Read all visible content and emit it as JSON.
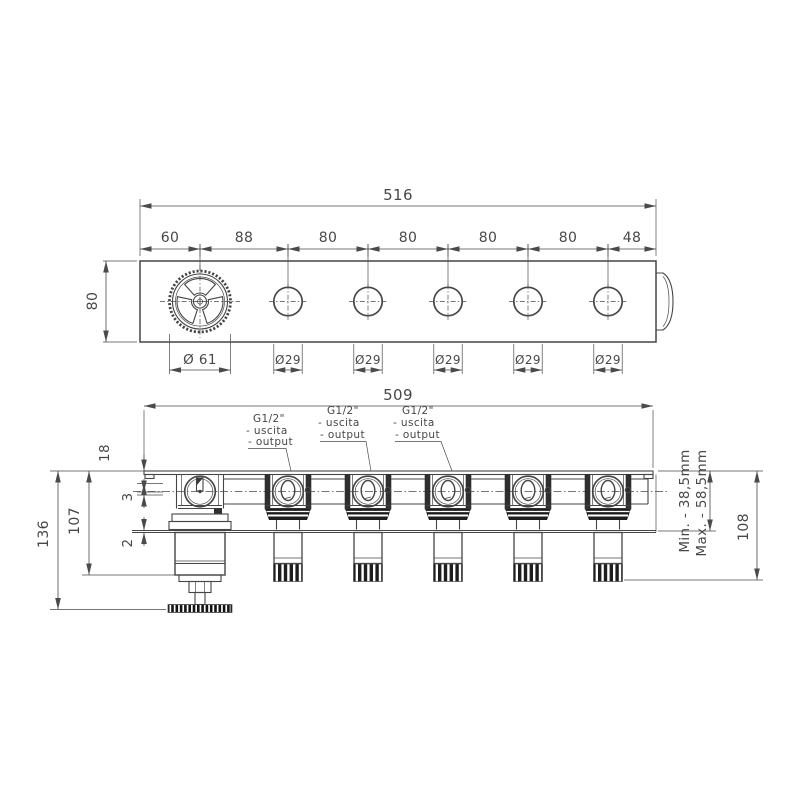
{
  "drawing": {
    "type": "technical-dimension-drawing",
    "views": [
      "top-view",
      "front-view"
    ],
    "top_view": {
      "overall_width": "516",
      "segments": [
        "60",
        "88",
        "80",
        "80",
        "80",
        "80",
        "48"
      ],
      "height": "80",
      "handwheel_diameter": "Ø 61",
      "port_diameter": "Ø29",
      "port_count": 5
    },
    "front_view": {
      "plate_width": "509",
      "outlet_label": {
        "size": "G1/2\"",
        "uscita": "- uscita",
        "output": "- output"
      },
      "outlet_count": 3,
      "dim_plate_offset": "18",
      "dim_axis_gap": "3",
      "dim_body_depth": "107",
      "dim_plate_thickness": "2",
      "dim_total_depth": "136",
      "min_depth": "Min. - 38,5mm",
      "max_depth": "Max. - 58,5mm",
      "dim_connector_depth": "108"
    },
    "colors": {
      "line": "#454545",
      "text": "#474747",
      "dark_fill": "#1d1d1d",
      "background": "#ffffff"
    }
  }
}
